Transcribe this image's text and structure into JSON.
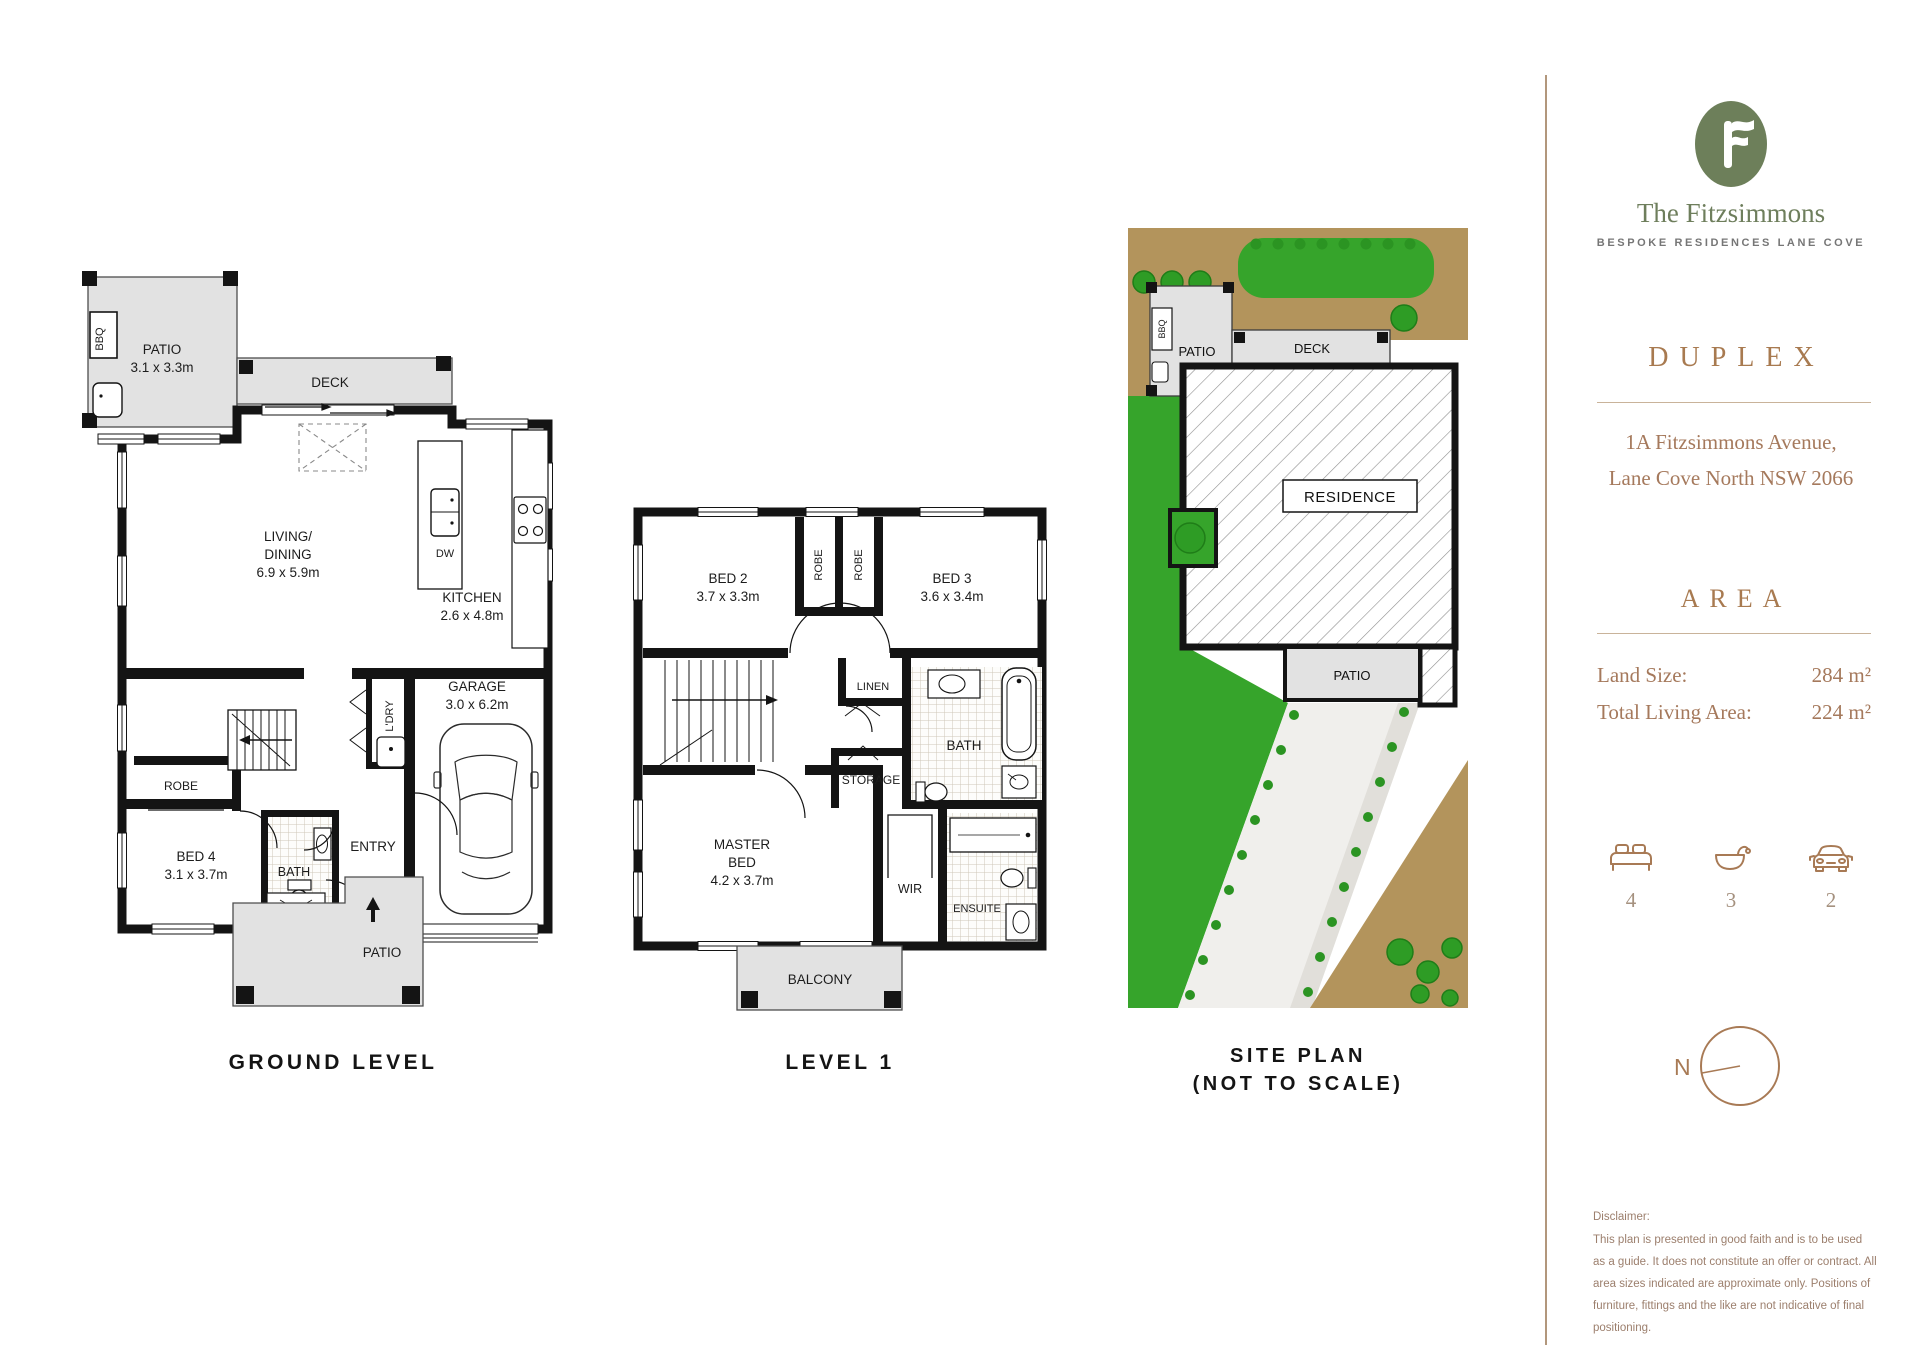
{
  "brand": {
    "logo_letter": "F",
    "name": "The Fitzsimmons",
    "tagline": "BESPOKE RESIDENCES LANE COVE"
  },
  "property": {
    "type": "DUPLEX",
    "address_line1": "1A Fitzsimmons Avenue,",
    "address_line2": "Lane Cove North NSW 2066"
  },
  "area": {
    "title": "AREA",
    "land_label": "Land Size:",
    "land_value": "284 m²",
    "living_label": "Total Living Area:",
    "living_value": "224 m²"
  },
  "features": {
    "beds": "4",
    "baths": "3",
    "cars": "2"
  },
  "compass": {
    "north_label": "N"
  },
  "disclaimer": {
    "title": "Disclaimer:",
    "body": "This plan is presented in good faith and is to be used as a guide. It does not constitute an offer or contract. All area sizes indicated are approximate only. Positions of furniture, fittings and the like are not indicative of final positioning."
  },
  "colors": {
    "brand_green": "#6d7f5a",
    "accent_brown": "#a87a55",
    "lawn_green": "#36a42b",
    "dirt_brown": "#b3945c"
  },
  "ground": {
    "title": "GROUND LEVEL",
    "patio_top": {
      "name": "PATIO",
      "dims": "3.1 x 3.3m"
    },
    "bbq": "BBQ",
    "deck": "DECK",
    "living": {
      "line1": "LIVING/",
      "line2": "DINING",
      "dims": "6.9 x 5.9m"
    },
    "kitchen": {
      "name": "KITCHEN",
      "dims": "2.6 x 4.8m"
    },
    "dw": "DW",
    "garage": {
      "name": "GARAGE",
      "dims": "3.0 x 6.2m"
    },
    "ldry": "L'DRY",
    "robe": "ROBE",
    "bed4": {
      "name": "BED 4",
      "dims": "3.1 x 3.7m"
    },
    "bath": "BATH",
    "entry": "ENTRY",
    "patio_bottom": "PATIO"
  },
  "level1": {
    "title": "LEVEL 1",
    "bed2": {
      "name": "BED 2",
      "dims": "3.7 x 3.3m"
    },
    "robe_left": "ROBE",
    "robe_right": "ROBE",
    "bed3": {
      "name": "BED 3",
      "dims": "3.6 x 3.4m"
    },
    "linen": "LINEN",
    "bath": "BATH",
    "storage": "STORAGE",
    "master": {
      "line1": "MASTER",
      "line2": "BED",
      "dims": "4.2 x 3.7m"
    },
    "wir": "WIR",
    "ensuite": "ENSUITE",
    "balcony": "BALCONY"
  },
  "site": {
    "title_line1": "SITE PLAN",
    "title_line2": "(NOT TO SCALE)",
    "patio_top": "PATIO",
    "bbq": "BBQ",
    "deck": "DECK",
    "residence": "RESIDENCE",
    "patio_bottom": "PATIO"
  }
}
